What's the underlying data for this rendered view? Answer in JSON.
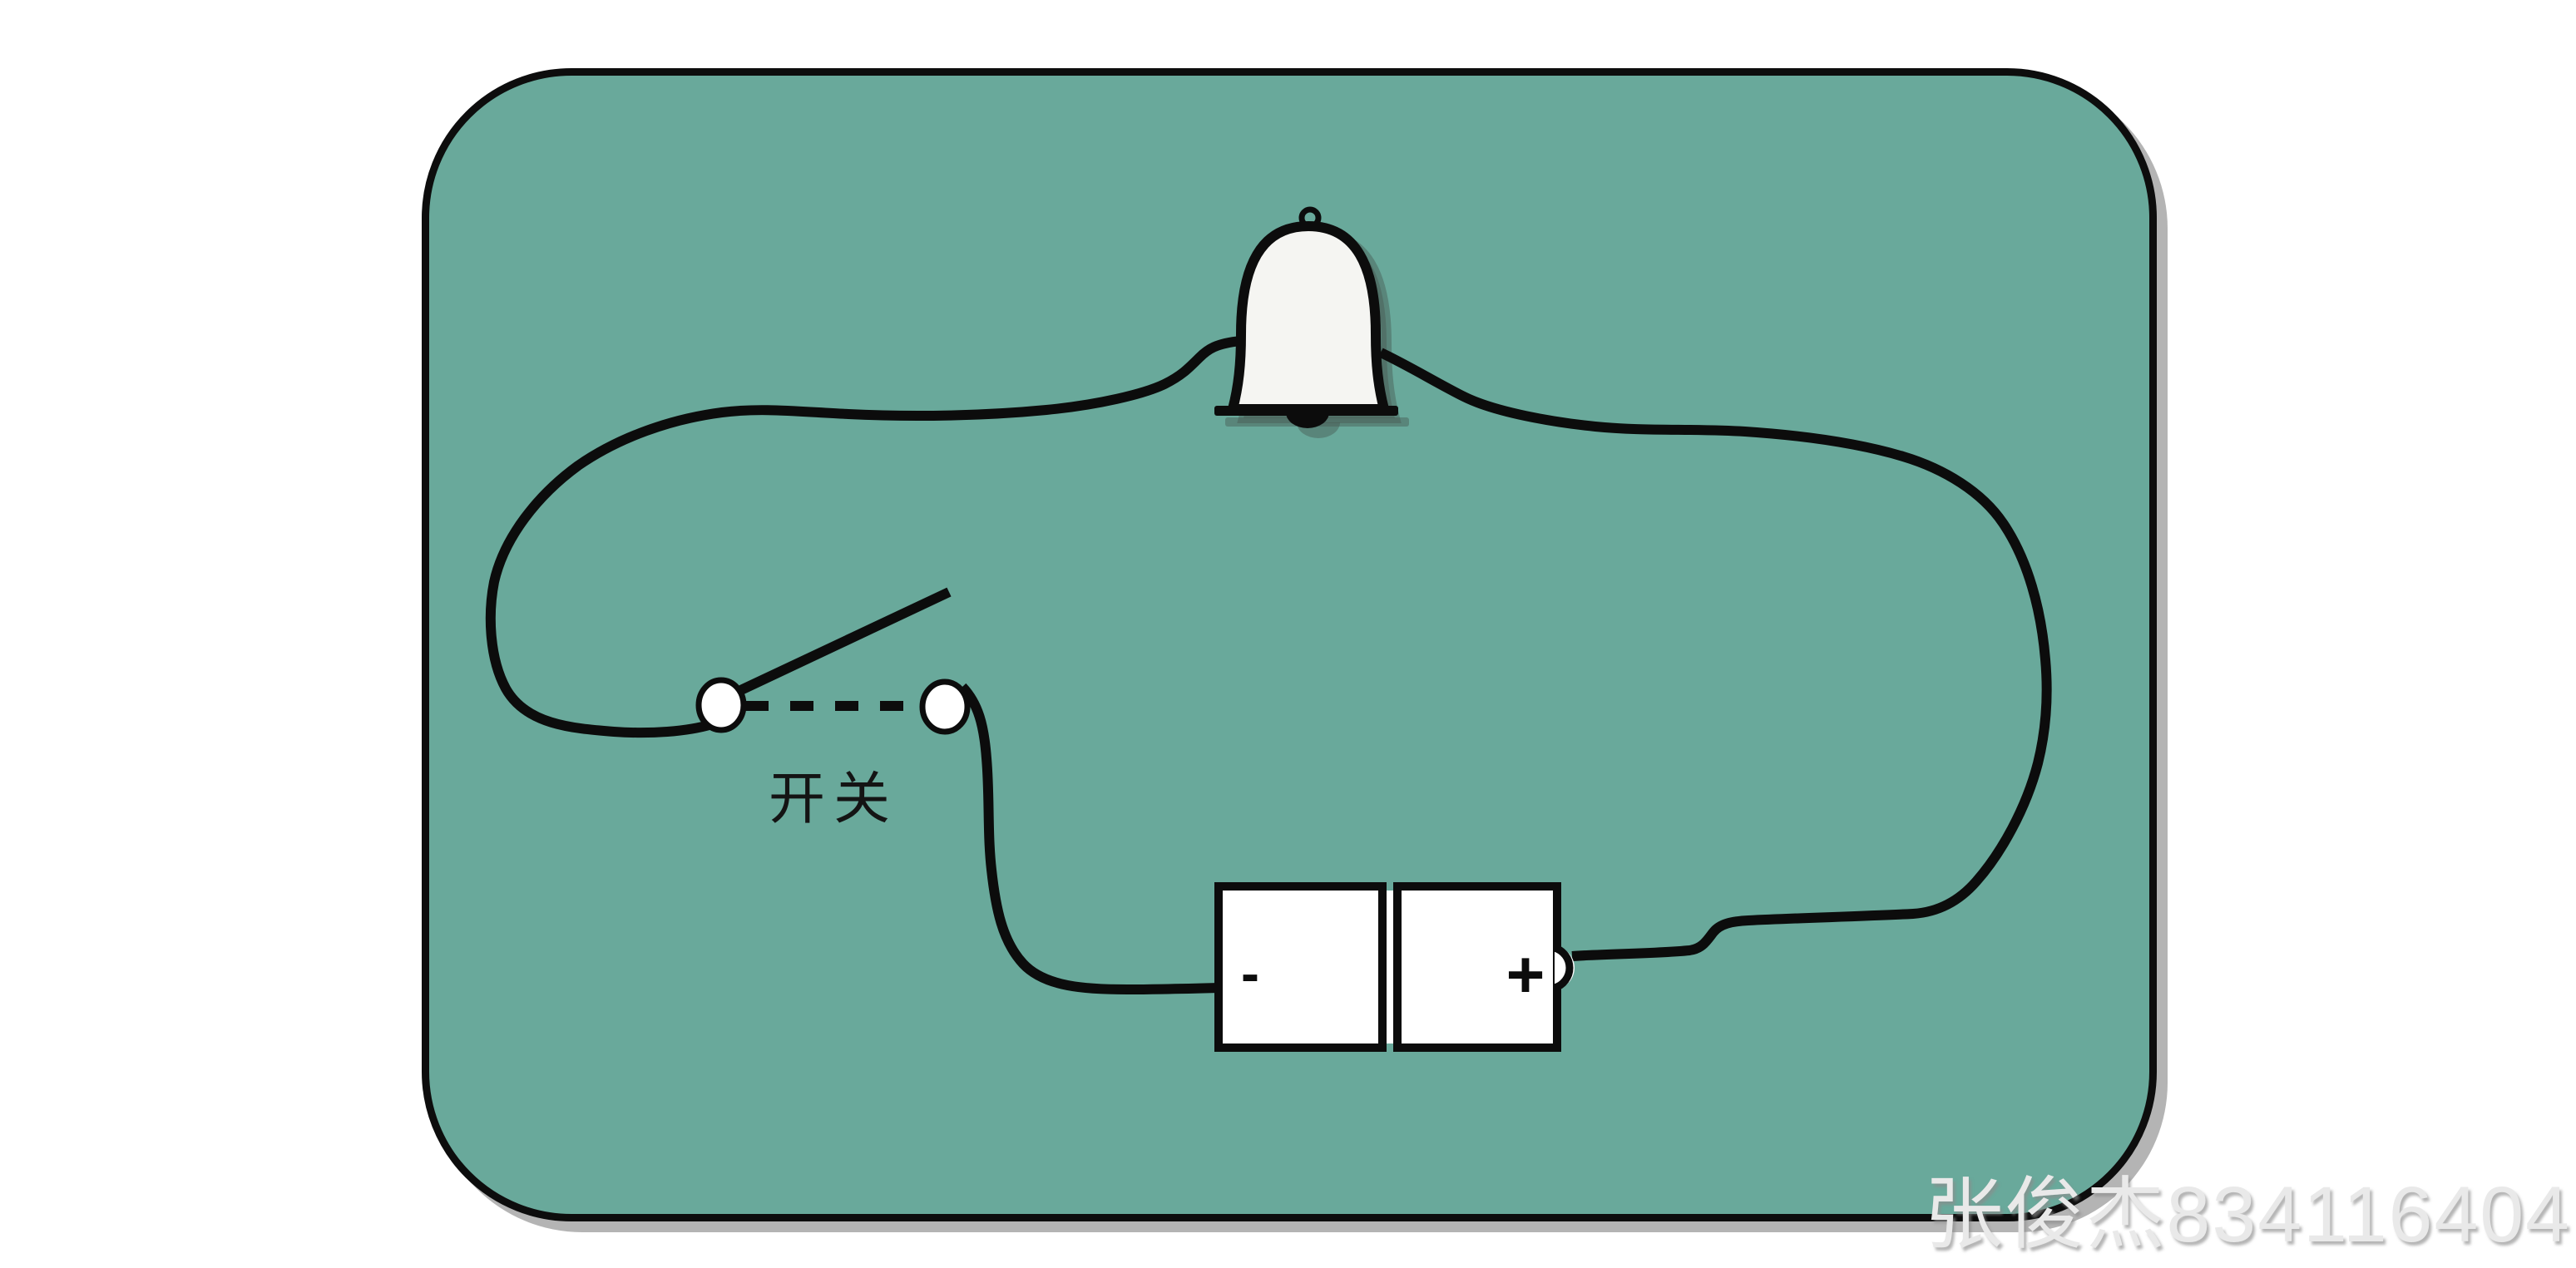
{
  "board": {
    "background_color": "#69a99b",
    "border_color": "#0d0d0d",
    "shadow_color": "#b4b4b4"
  },
  "components": {
    "bell": {
      "icon": "bell-icon",
      "fill_color": "#f5f5f2"
    },
    "switch": {
      "label": "开关",
      "state": "open",
      "terminal_fill": "#ffffff"
    },
    "battery": {
      "negative_label": "-",
      "positive_label": "+",
      "fill_color": "#ffffff"
    }
  },
  "wires": {
    "color": "#0c0c0c"
  },
  "watermark": {
    "text": "张俊杰834116404",
    "color": "#e9e9e9"
  }
}
